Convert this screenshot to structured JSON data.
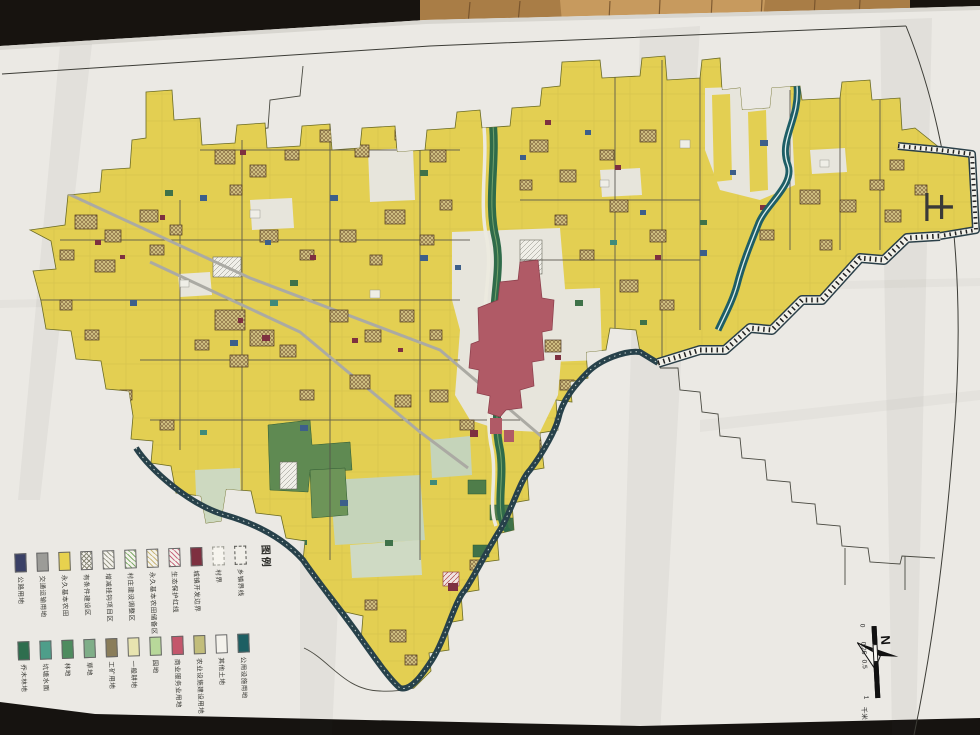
{
  "scene": {
    "description": "photograph of a township land-use planning paper map lying on a wood table, sheet rotated 90°"
  },
  "legend": {
    "title": "图例",
    "row1": [
      {
        "label": "公路用地",
        "type": "solid",
        "color": "#3a4066"
      },
      {
        "label": "交通运输用地",
        "type": "solid",
        "color": "#9c9c98"
      },
      {
        "label": "永久基本农田",
        "type": "solid",
        "color": "#e8d24e"
      },
      {
        "label": "有条件建设区",
        "type": "cross",
        "color": "#8a8a7a"
      },
      {
        "label": "增减挂钩项目区",
        "type": "hatch",
        "color": "#9a9a8a"
      },
      {
        "label": "村庄建设调整区",
        "type": "hatch",
        "color": "#7fae6a"
      },
      {
        "label": "永久基本农田储备区",
        "type": "hatch",
        "color": "#c9b87a"
      },
      {
        "label": "生态保护红线",
        "type": "hatch",
        "color": "#c96a80"
      },
      {
        "label": "城镇开发边界",
        "type": "solid",
        "color": "#7e3040"
      },
      {
        "label": "村界",
        "type": "dashed-light",
        "color": "#999990"
      },
      {
        "label": "乡镇界线",
        "type": "dashed",
        "color": "#555550"
      }
    ],
    "row2": [
      {
        "label": "乔木林地",
        "type": "solid",
        "color": "#2e6e4e"
      },
      {
        "label": "坑塘水面",
        "type": "solid",
        "color": "#4e9e8a"
      },
      {
        "label": "林地",
        "type": "solid",
        "color": "#4e8c5f"
      },
      {
        "label": "草地",
        "type": "solid",
        "color": "#7fae88"
      },
      {
        "label": "工矿用地",
        "type": "solid",
        "color": "#8a7d5a"
      },
      {
        "label": "一般耕地",
        "type": "solid",
        "color": "#e8e4b0"
      },
      {
        "label": "园地",
        "type": "solid",
        "color": "#b8d89a"
      },
      {
        "label": "商业服务业用地",
        "type": "solid",
        "color": "#c4566b"
      },
      {
        "label": "农业设施建设用地",
        "type": "solid",
        "color": "#c2bd7a"
      },
      {
        "label": "其他土地",
        "type": "solid",
        "color": "#f4f2ec"
      },
      {
        "label": "公用设施用地",
        "type": "solid",
        "color": "#1d5f63"
      }
    ]
  },
  "scalebar": {
    "tick0": "0",
    "tick1": "0.25",
    "tick2": "0.5",
    "tick3": "1",
    "unit": "千米"
  },
  "compass": {
    "label": "N"
  },
  "title_fragment": "土",
  "colors": {
    "farmland": "#e3cf52",
    "urban_red": "#b05a66",
    "greenway": "#2f6b4a",
    "water_teal": "#1e5e66",
    "boundary_band": "#27414a",
    "village_hatch": "#cdbd80",
    "paper": "#ebe9e4",
    "wood": "#b08048"
  }
}
